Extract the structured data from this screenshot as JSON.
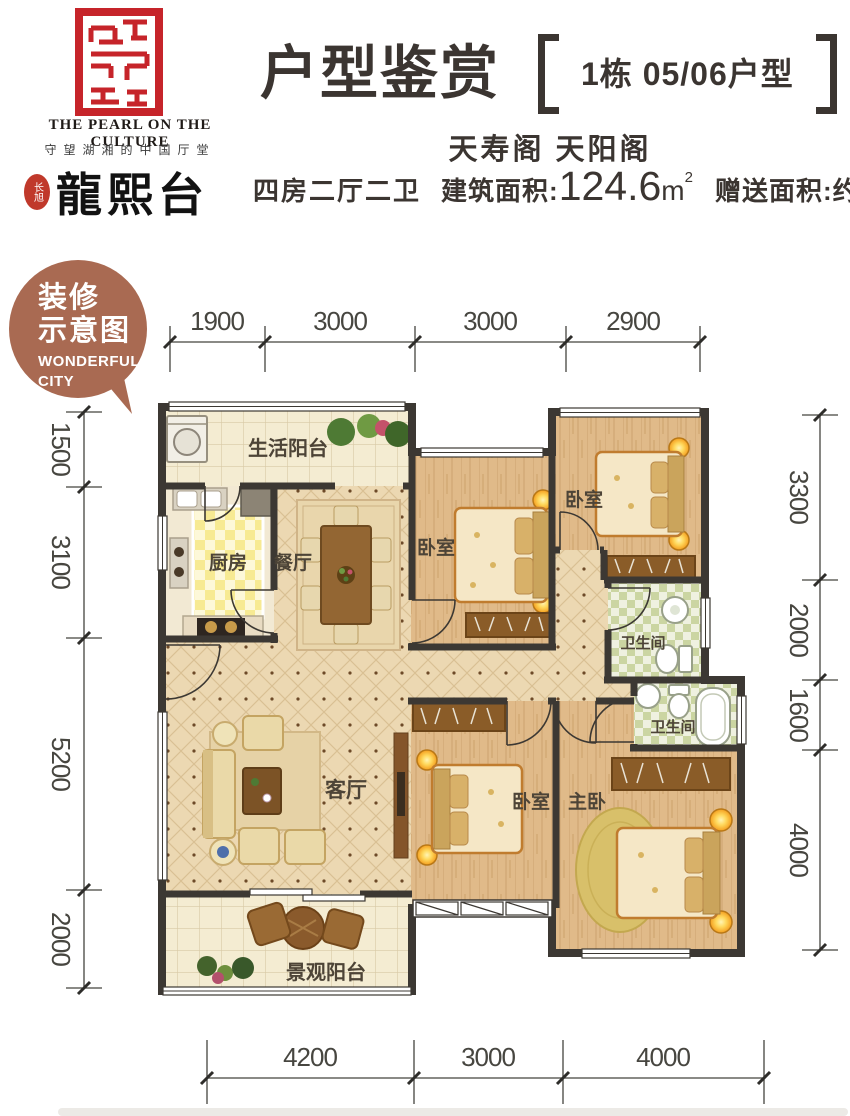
{
  "logo": {
    "seal_icon": "red-seal-emblem",
    "tagline_en": "THE PEARL ON THE CULTURE",
    "tagline_cn": "守望湖湘的中国厅堂",
    "badge": "长旭",
    "brand": "龍熙台"
  },
  "header": {
    "title": "户型鉴赏",
    "unit_tag": "1栋 05/06户型",
    "buildings": "天寿阁 天阳阁",
    "spec": "四房二厅二卫",
    "area_label": "建筑面积:",
    "area_value": "124.6",
    "area_unit": "m",
    "area_sup": "2",
    "gift_label": "赠送面积:约",
    "gift_value": "24.83",
    "gift_unit": "m",
    "gift_sup": "2"
  },
  "bubble": {
    "line1": "装修",
    "line2": "示意图",
    "line3": "WONDERFUL",
    "line4": "CITY",
    "color": "#a96a52"
  },
  "dimensions": {
    "top": [
      "1900",
      "3000",
      "3000",
      "2900"
    ],
    "left": [
      "1500",
      "3100",
      "5200",
      "2000"
    ],
    "right": [
      "3300",
      "2000",
      "1600",
      "4000"
    ],
    "bottom": [
      "4200",
      "3000",
      "4000"
    ]
  },
  "rooms": {
    "service_balcony": "生活阳台",
    "kitchen": "厨房",
    "dining": "餐厅",
    "bedroom1": "卧室",
    "bedroom2": "卧室",
    "bedroom3": "卧室",
    "master": "主卧",
    "bath1": "卫生间",
    "bath2": "卫生间",
    "living": "客厅",
    "view_balcony": "景观阳台"
  },
  "colors": {
    "seal_red": "#c6242a",
    "bubble": "#a96a52",
    "wall": "#3c3833",
    "heading_text": "#3b3531",
    "dim_text": "#474640"
  }
}
